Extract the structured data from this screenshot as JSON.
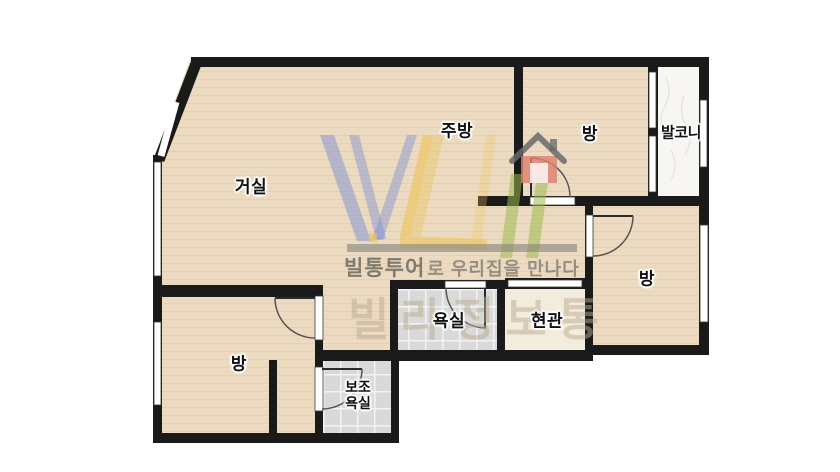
{
  "plan": {
    "rooms": {
      "living": {
        "label": "거실"
      },
      "kitchen": {
        "label": "주방"
      },
      "room_top": {
        "label": "방"
      },
      "balcony": {
        "label": "발코니"
      },
      "room_right": {
        "label": "방"
      },
      "bathroom": {
        "label": "욕실"
      },
      "entrance": {
        "label": "현관"
      },
      "room_left": {
        "label": "방"
      },
      "aux_bathroom": {
        "label_line1": "보조",
        "label_line2": "욕실"
      }
    }
  },
  "watermark": {
    "tagline_brand": "빌통투어",
    "tagline_rest": "로 우리집을 만나다",
    "big_text": "빌라정보통"
  },
  "colors": {
    "wall": "#1a1a1a",
    "floor_wood": "#ecdbc0",
    "floor_tile": "#d9d9d9",
    "balcony_floor": "#f7f6f2",
    "entrance_floor": "#f2ecdd",
    "logo_blue": "#7e90d2",
    "logo_yellow": "#eec35a",
    "logo_green": "#9cb84e",
    "logo_red": "#dd7e6f",
    "logo_gray": "#85837c"
  }
}
